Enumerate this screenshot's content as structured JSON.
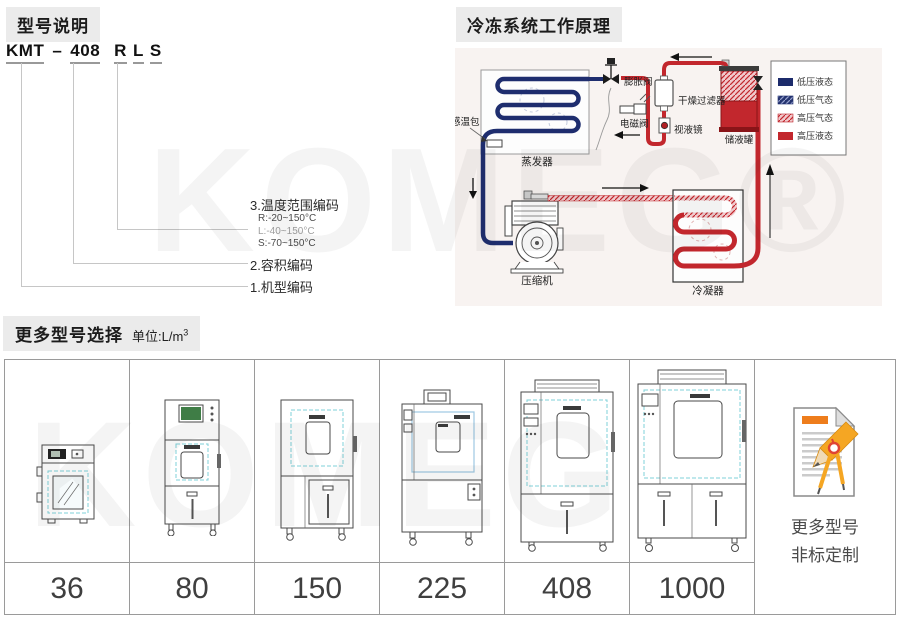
{
  "watermarks": [
    "KOMEG®",
    "KOMEG"
  ],
  "model_section": {
    "heading": "型号说明",
    "code": {
      "prefix": "KMT",
      "dash": "–",
      "volume": "408",
      "letters": [
        "R",
        "L",
        "S"
      ]
    },
    "annotations": [
      {
        "label": "3.温度范围编码",
        "options": [
          "R:-20~150°C",
          "L:-40~150°C",
          "S:-70~150°C"
        ]
      },
      {
        "label": "2.容积编码"
      },
      {
        "label": "1.机型编码"
      }
    ]
  },
  "diagram_section": {
    "heading": "冷冻系统工作原理",
    "labels": {
      "evaporator": "蒸发器",
      "compressor": "压缩机",
      "condenser": "冷凝器",
      "sensor_bulb": "感温包",
      "expansion_valve": "膨胀阀",
      "solenoid_valve": "电磁阀",
      "dry_filter": "干燥过滤器",
      "sight_glass": "视液镜",
      "receiver": "储液罐"
    },
    "legend": [
      {
        "label": "低压液态",
        "style": "solid",
        "color": "#1c2b6b"
      },
      {
        "label": "低压气态",
        "style": "hatched",
        "color": "#1c2b6b"
      },
      {
        "label": "高压气态",
        "style": "hatched",
        "color": "#c2272d"
      },
      {
        "label": "高压液态",
        "style": "solid",
        "color": "#c2272d"
      }
    ]
  },
  "models_section": {
    "heading": "更多型号选择",
    "unit_label": "单位:L/m",
    "unit_sup": "3",
    "models": [
      {
        "volume": "36"
      },
      {
        "volume": "80"
      },
      {
        "volume": "150"
      },
      {
        "volume": "225"
      },
      {
        "volume": "408"
      },
      {
        "volume": "1000"
      }
    ],
    "custom": {
      "line1": "更多型号",
      "line2": "非标定制"
    }
  }
}
